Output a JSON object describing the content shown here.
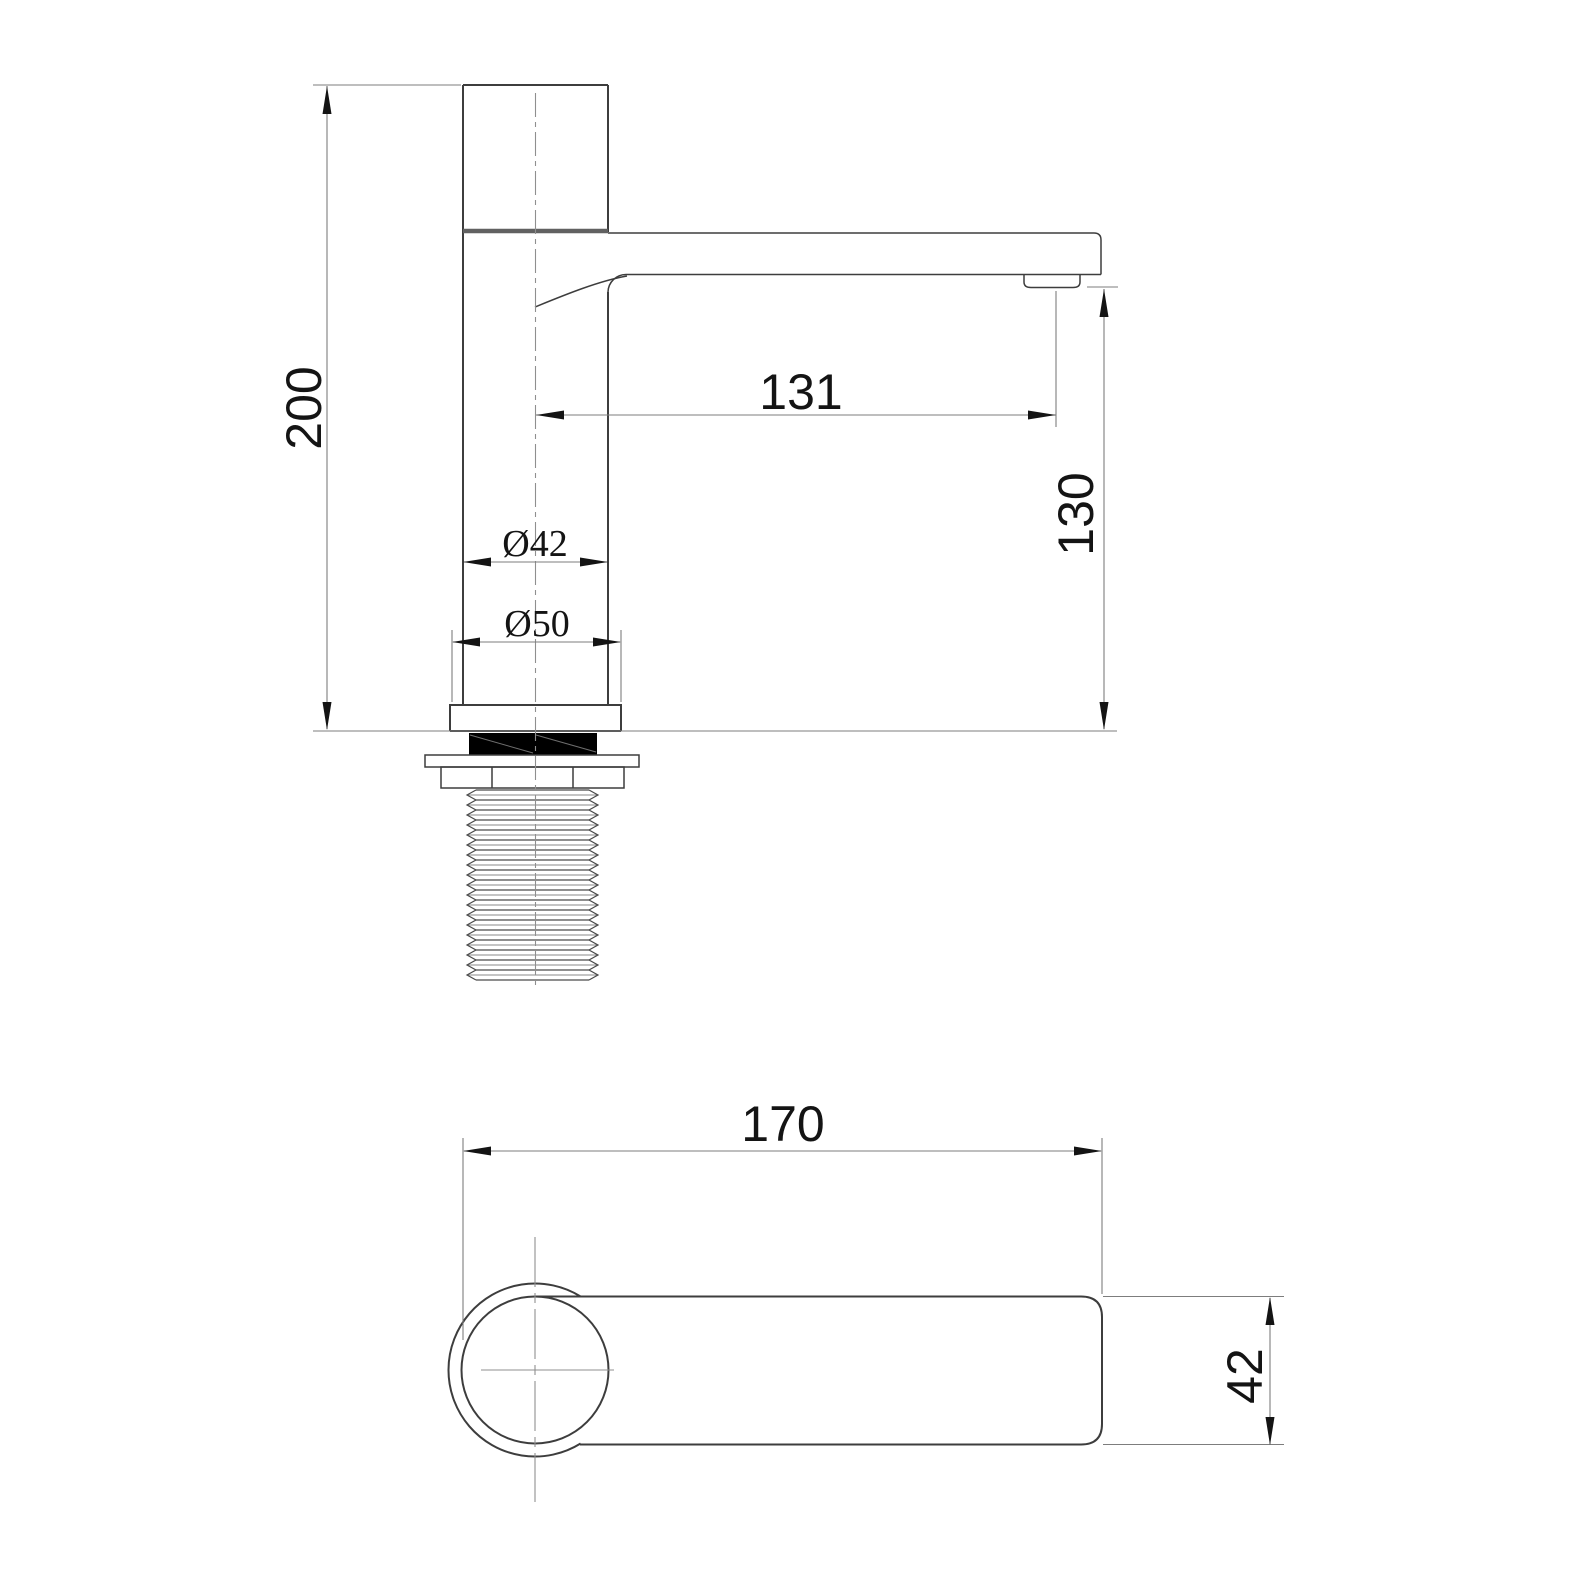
{
  "colors": {
    "background": "#ffffff",
    "line": "#3d3d3d",
    "dim": "#7d7d7d",
    "text": "#141414",
    "gasket": "#000000"
  },
  "front_view": {
    "dim_height": "200",
    "dim_spout_reach": "131",
    "dim_outlet_height": "130",
    "dim_body_diameter": "Ø42",
    "dim_base_diameter": "Ø50"
  },
  "top_view": {
    "dim_length": "170",
    "dim_width": "42"
  }
}
